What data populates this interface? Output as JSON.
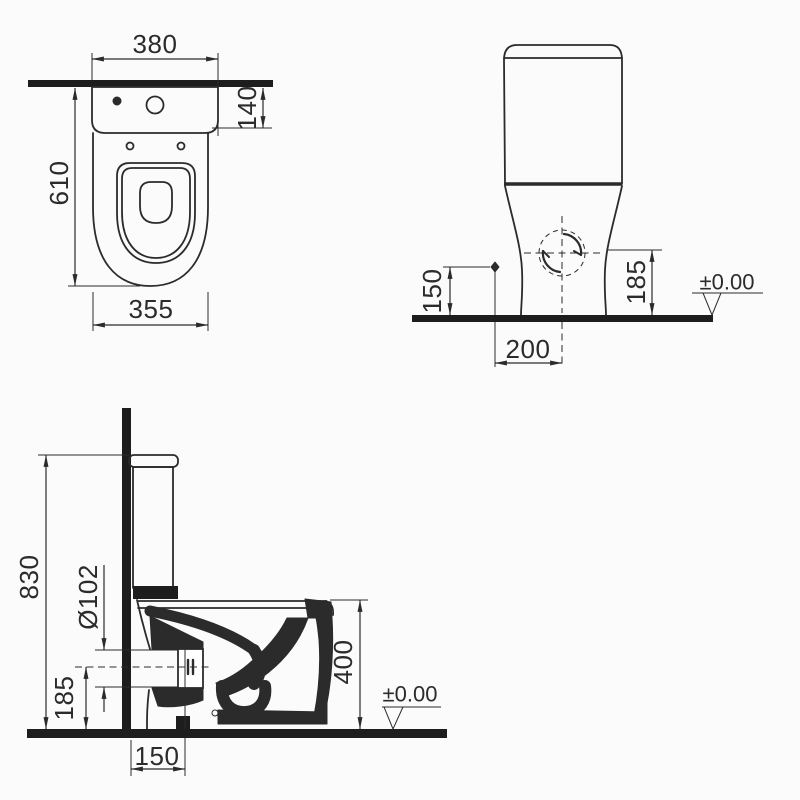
{
  "drawing": {
    "subject": "close-coupled toilet technical drawing, three orthographic views",
    "colors": {
      "line": "#2b2b2b",
      "thick_bars": "#1d1d1d",
      "background": "#fbfbfb"
    }
  },
  "views": {
    "top": {
      "label": "top view",
      "dims": {
        "overall_width": "380",
        "tank_depth": "140",
        "overall_depth": "610",
        "bowl_width": "355"
      }
    },
    "front": {
      "label": "front view",
      "dims": {
        "supply_height": "150",
        "connection_height": "185",
        "connection_offset": "200",
        "floor_level": "±0.00"
      }
    },
    "side": {
      "label": "side section view",
      "dims": {
        "overall_height": "830",
        "outlet_diameter": "Ø102",
        "outlet_axis_height": "185",
        "outlet_wall_distance": "150",
        "rim_height": "400",
        "floor_level": "±0.00"
      }
    }
  }
}
